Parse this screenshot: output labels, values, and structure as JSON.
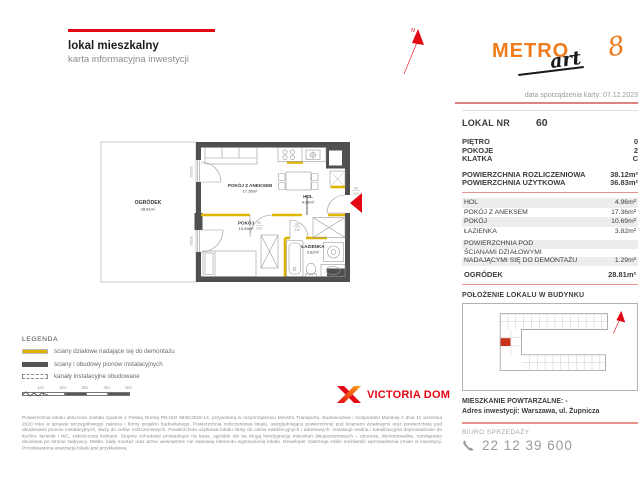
{
  "colors": {
    "accent_red": "#e30613",
    "brand_orange": "#ee7b1c",
    "wall_gray": "#4f4f4f",
    "demolition_yellow": "#dfb400",
    "divider_pink": "#e8928c",
    "stripe_gray": "#ededed"
  },
  "header": {
    "doc_type": "lokal mieszkalny",
    "doc_subtitle": "karta informacyjna inwestycji",
    "date_note": "data sporządzenia karty: 07.12.2023"
  },
  "brand": {
    "metro": "METRO",
    "art": "art",
    "eight": "8",
    "compass_n": "N",
    "victoria": "VICTORIA DOM"
  },
  "panel": {
    "lokal_label": "LOKAL NR",
    "lokal_number": "60",
    "attributes": [
      {
        "label": "PIĘTRO",
        "value": "0"
      },
      {
        "label": "POKOJE",
        "value": "2"
      },
      {
        "label": "KLATKA",
        "value": "C"
      }
    ],
    "area_summary": [
      {
        "label": "POWIERZCHNIA ROZLICZENIOWA",
        "value": "38.12m²"
      },
      {
        "label": "POWIERZCHNIA UŻYTKOWA",
        "value": "36.83m²"
      }
    ],
    "rooms": [
      {
        "label": "HOL",
        "value": "4.96m²"
      },
      {
        "label": "POKÓJ Z ANEKSEM",
        "value": "17.36m²"
      },
      {
        "label": "POKÓJ",
        "value": "10.69m²"
      },
      {
        "label": "ŁAZIENKA",
        "value": "3.82m²"
      }
    ],
    "demountable": {
      "line1": "POWIERZCHNIA POD",
      "line2": "ŚCIANAMI DZIAŁOWYMI",
      "line3": "NADAJĄCYMI SIĘ DO DEMONTAŻU",
      "value": "1.29m²"
    },
    "garden": {
      "label": "OGRÓDEK",
      "value": "28.81m²"
    },
    "position_title": "POŁOŻENIE LOKALU W BUDYNKU",
    "repeatable": "MIESZKANIE POWTARZALNE: -",
    "address": "Adres inwestycji: Warszawa, ul. Żupnicza",
    "office_label": "BIURO SPRZEDAŻY",
    "phone": "22 12 39 600"
  },
  "plan": {
    "garden": {
      "name": "OGRÓDEK",
      "area": "28.81m²"
    },
    "living": {
      "name": "POKÓJ Z ANEKSEM",
      "area": "17.36m²"
    },
    "hall": {
      "name": "HOL",
      "area": "4.96m²"
    },
    "room": {
      "name": "POKÓJ",
      "area": "10.69m²"
    },
    "bath": {
      "name": "ŁAZIENKA",
      "area": "3.82m²"
    },
    "dims": {
      "balcony_door_top": "200/230",
      "balcony_door_bottom": "90/230",
      "entrance_top": "90",
      "entrance_bottom": "210",
      "bath_top": "80",
      "bath_bottom": "210",
      "room_top": "90",
      "room_bottom": "210"
    }
  },
  "legend": {
    "title": "LEGENDA",
    "items": [
      "ściany działowe nadające się do demontażu",
      "ściany i obudowy pionów instalacyjnych",
      "kanały instalacyjne obudowane"
    ],
    "scale_ticks": [
      "1m",
      "2m",
      "3m",
      "4m",
      "5m"
    ]
  },
  "footer": {
    "disclaimer": "Powierzchnia lokalu obliczona została zgodnie z Polską Normą PN-ISO 9836:2015-12, przywołaną w rozporządzeniu Ministra Transportu, Budownictwa i Gospodarki Morskiej z dnia 11 września 2020 roku w sprawie szczegółowego zakresu i formy projektu budowlanego. Powierzchnia rozliczeniowa lokalu, uwzględniająca powierzchnię pod ścianami działowymi oraz powierzchnię pod obudowami pionów instalacyjnych, służy do celów rozliczeniowych. Powierzchnia użytkowa lokalu służy do celów ewidencyjnych i adresowych. Instalacje wodna i kanalizacyjna doprowadzone do kuchni, łazienki i WC, zakończone korkami. Stopnie schodowe prowadzące na taras, ogródek lub na drugą kondygnację mieszkań dwupoziomowych – ażurowe, demontowalne, rozwiązanie docelowe po stronie Nabywcy. Meble, biały montaż oraz drzwi wewnętrzne nie stanowią elementu wyposażenia lokalu. Deweloper zastrzega sobie możliwość wprowadzenia zmian w inwestycji. Przedstawiona aranżacja lokalu jest przykładowa."
  }
}
